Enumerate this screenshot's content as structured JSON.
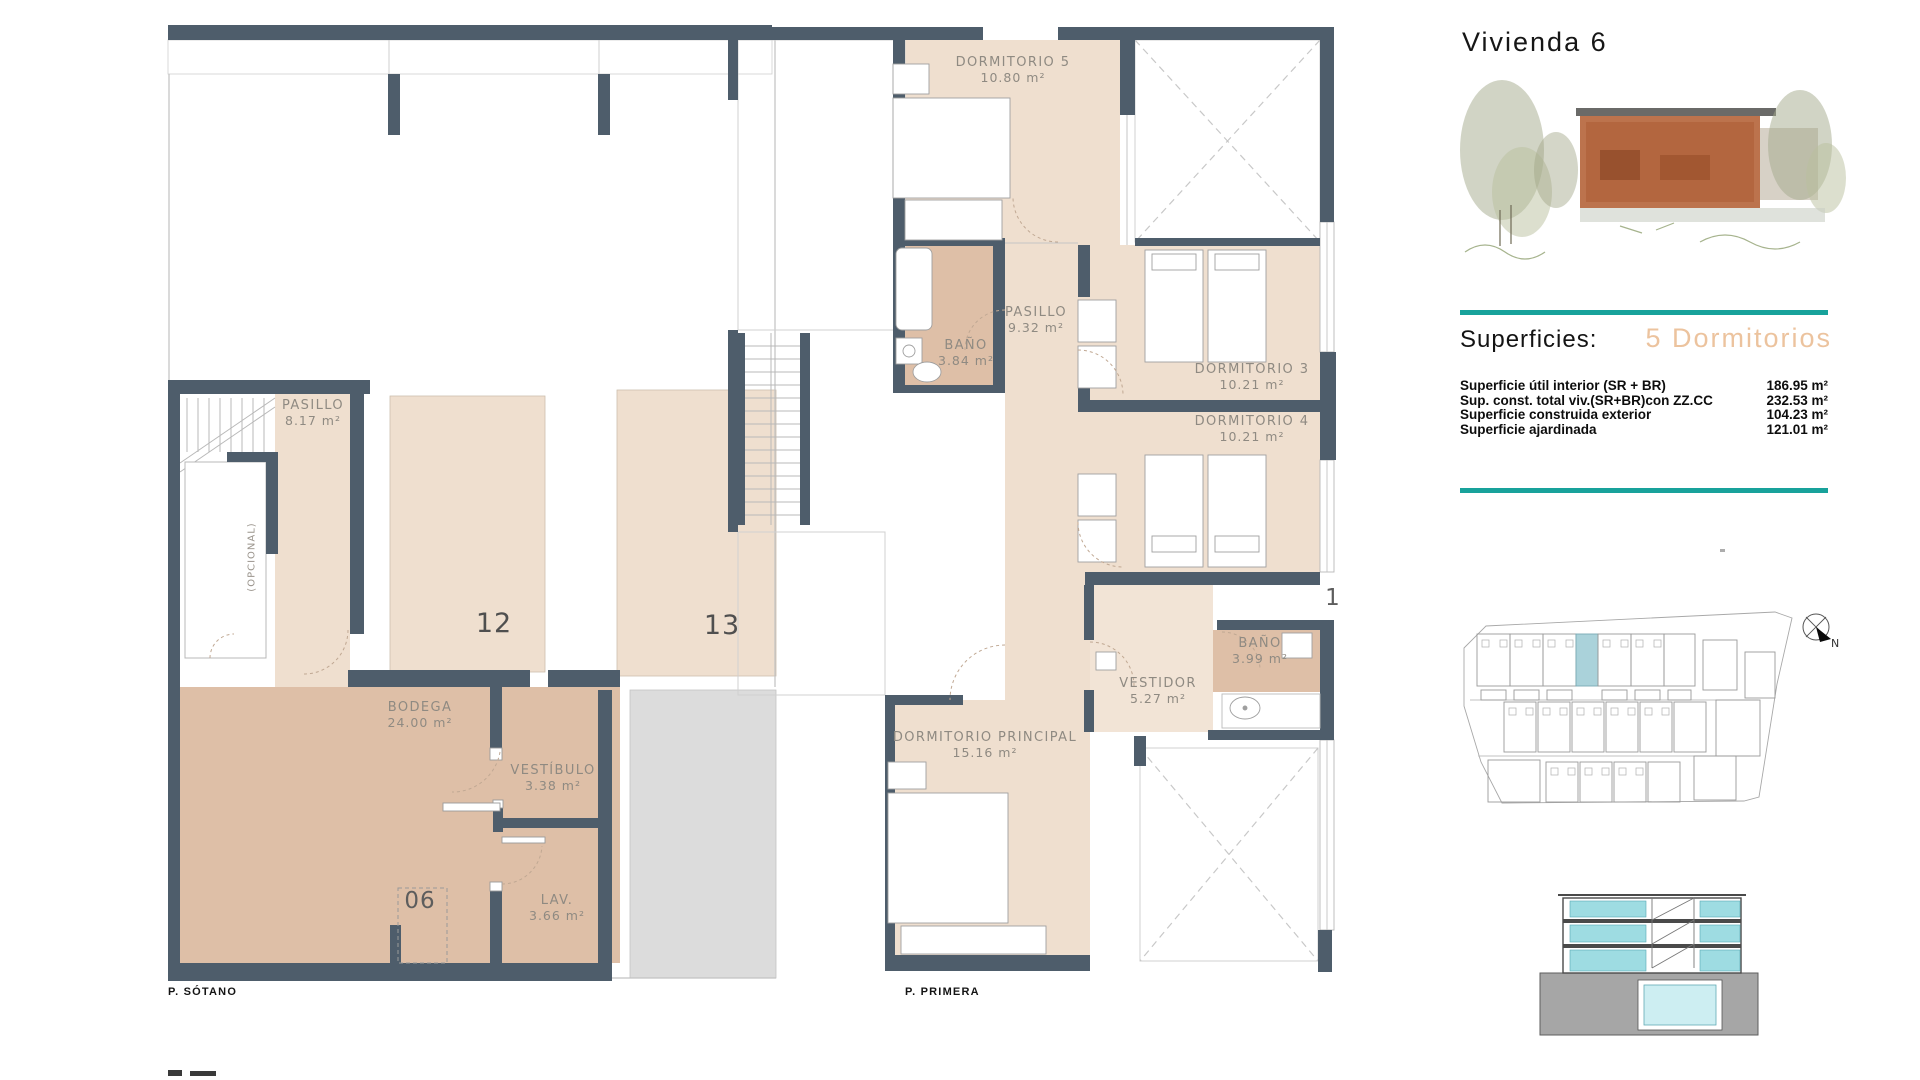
{
  "header": {
    "title": "Vivienda 6"
  },
  "plans": {
    "sotano": {
      "label": "P. SÓTANO",
      "rooms": [
        {
          "name": "PASILLO",
          "area": "8.17 m²"
        },
        {
          "name": "BODEGA",
          "area": "24.00 m²"
        },
        {
          "name": "VESTÍBULO",
          "area": "3.38 m²"
        },
        {
          "name": "LAV.",
          "area": "3.66 m²"
        }
      ],
      "plot_numbers": [
        "12",
        "13",
        "06"
      ],
      "stair_note": "(OPCIONAL)"
    },
    "primera": {
      "label": "P. PRIMERA",
      "rooms": [
        {
          "name": "DORMITORIO 5",
          "area": "10.80 m²"
        },
        {
          "name": "BAÑO",
          "area": "3.84 m²"
        },
        {
          "name": "PASILLO",
          "area": "9.32 m²"
        },
        {
          "name": "DORMITORIO 3",
          "area": "10.21 m²"
        },
        {
          "name": "DORMITORIO 4",
          "area": "10.21 m²"
        },
        {
          "name": "BAÑO",
          "area": "3.99 m²"
        },
        {
          "name": "VESTIDOR",
          "area": "5.27 m²"
        },
        {
          "name": "DORMITORIO PRINCIPAL",
          "area": "15.16 m²"
        }
      ],
      "edge_number": "1"
    }
  },
  "summary": {
    "section_label": "Superficies:",
    "type_label": "5 Dormitorios",
    "rows": [
      {
        "label": "Superficie útil interior (SR + BR)",
        "value": "186.95 m²"
      },
      {
        "label": "Sup. const. total viv.(SR+BR)con ZZ.CC",
        "value": "232.53 m²"
      },
      {
        "label": "Superficie construida exterior",
        "value": "104.23 m²"
      },
      {
        "label": "Superficie ajardinada",
        "value": "121.01 m²"
      }
    ]
  },
  "site_plan": {
    "north_label": "N"
  },
  "colors": {
    "wall": "#4e5d6b",
    "floor_beige": "#efdfcf",
    "floor_tan": "#debfa7",
    "exterior_gray": "#dcdcdc",
    "accent_teal": "#18a29b",
    "type_salmon": "#ecc39e",
    "site_highlight": "#aad2da",
    "section_glass": "#9edce2"
  }
}
